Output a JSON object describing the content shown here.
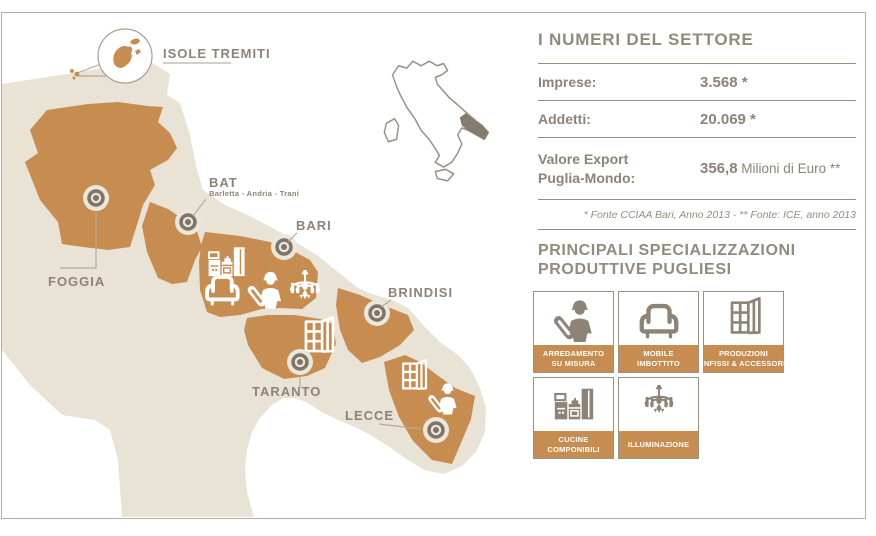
{
  "map": {
    "isole_tremiti": {
      "label": "ISOLE TREMITI"
    },
    "provinces": {
      "foggia": {
        "label": "FOGGIA"
      },
      "bat": {
        "label": "BAT",
        "sublabel": "Barletta - Andria - Trani"
      },
      "bari": {
        "label": "BARI"
      },
      "brindisi": {
        "label": "BRINDISI"
      },
      "taranto": {
        "label": "TARANTO"
      },
      "lecce": {
        "label": "LECCE"
      }
    },
    "bari_icons": [
      "kitchen-icon",
      "armchair-icon",
      "worker-blueprint-icon",
      "chandelier-icon"
    ],
    "taranto_icons": [
      "window-icon"
    ],
    "lecce_icons": [
      "window-icon",
      "worker-blueprint-icon"
    ],
    "minimap": {
      "highlight_region": "Puglia"
    }
  },
  "stats_panel": {
    "title": "I NUMERI DEL SETTORE",
    "rows": [
      {
        "label": "Imprese:",
        "value": "3.568",
        "suffix": " *"
      },
      {
        "label": "Addetti:",
        "value": "20.069",
        "suffix": " *"
      },
      {
        "label_line1": "Valore Export",
        "label_line2": "Puglia-Mondo:",
        "value": "356,8",
        "suffix": " Milioni di Euro **"
      }
    ],
    "footnote": "* Fonte CCIAA Bari, Anno 2013 - ** Fonte: ICE, anno 2013"
  },
  "specializations": {
    "title_line1": "PRINCIPALI SPECIALIZZAZIONI",
    "title_line2": "PRODUTTIVE PUGLIESI",
    "items": [
      {
        "label_line1": "ARREDAMENTO",
        "label_line2": "SU MISURA",
        "icon": "worker-blueprint-icon"
      },
      {
        "label_line1": "MOBILE",
        "label_line2": "IMBOTTITO",
        "icon": "armchair-icon"
      },
      {
        "label_line1": "PRODUZIONI",
        "label_line2": "INFISSI & ACCESSORI",
        "icon": "window-icon"
      },
      {
        "label_line1": "CUCINE",
        "label_line2": "COMPONIBILI",
        "icon": "kitchen-icon"
      },
      {
        "label_line1": "ILLUMINAZIONE",
        "label_line2": "",
        "icon": "chandelier-icon"
      }
    ]
  },
  "colors": {
    "orange": "#c78c4f",
    "beige": "#e9e3d6",
    "taupe_text": "#8d8377",
    "rule": "#978e80",
    "frame_border": "#b6ae9f",
    "marker_dark": "#7d7567",
    "marker_cream": "#ece7db",
    "minimap_fill": "#847c6c"
  }
}
